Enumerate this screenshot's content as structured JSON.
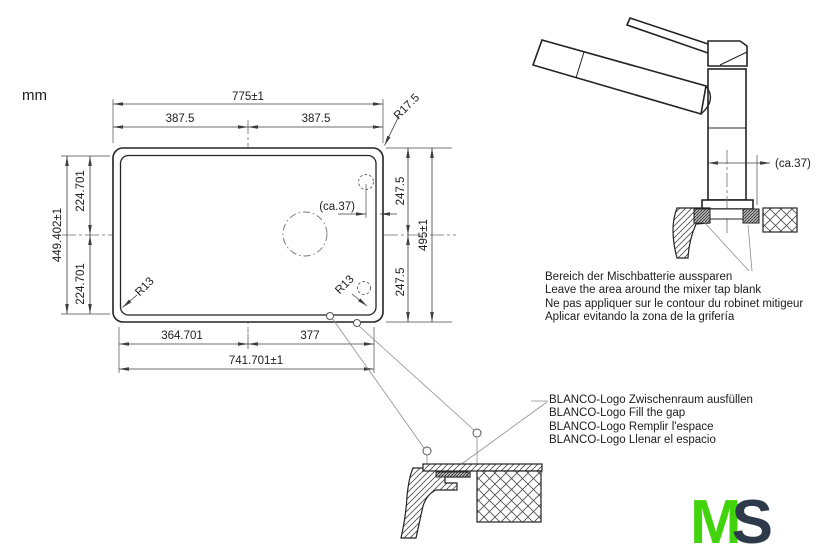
{
  "unit_label": "mm",
  "sink_plan": {
    "dims": {
      "width_total": "775±1",
      "width_half_left": "387.5",
      "width_half_right": "387.5",
      "corner_radius": "R17.5",
      "height_half_top": "247.5",
      "height_total": "495±1",
      "height_half_bottom": "247.5",
      "depth_total": "449.402±1",
      "depth_half_top": "224.701",
      "depth_half_bottom": "224.701",
      "inner_radius_left": "R13",
      "inner_radius_right": "R13",
      "tap_offset": "(ca.37)",
      "bottom_left": "364.701",
      "bottom_right": "377",
      "bottom_total": "741.701±1"
    }
  },
  "tap_detail": {
    "dim_offset": "(ca.37)"
  },
  "notes": {
    "mixer_tap": [
      "Bereich der Mischbatterie aussparen",
      "Leave the area around the mixer tap blank",
      "Ne pas appliquer sur le contour du robinet mitigeur",
      "Aplicar evitando la zona de la grifería"
    ],
    "logo_gap": [
      "BLANCO-Logo Zwischenraum ausfüllen",
      "BLANCO-Logo Fill the gap",
      "BLANCO-Logo Remplir l'espace",
      "BLANCO-Logo Llenar el espacio"
    ]
  },
  "logo": {
    "letter_m": "M",
    "letter_s": "S",
    "m_color": "#41d30b",
    "s_color": "#2d3a49"
  },
  "colors": {
    "line_art": "#232323",
    "dimension": "#3d3d3d",
    "leader": "#8f8f8f",
    "background": "#ffffff"
  }
}
